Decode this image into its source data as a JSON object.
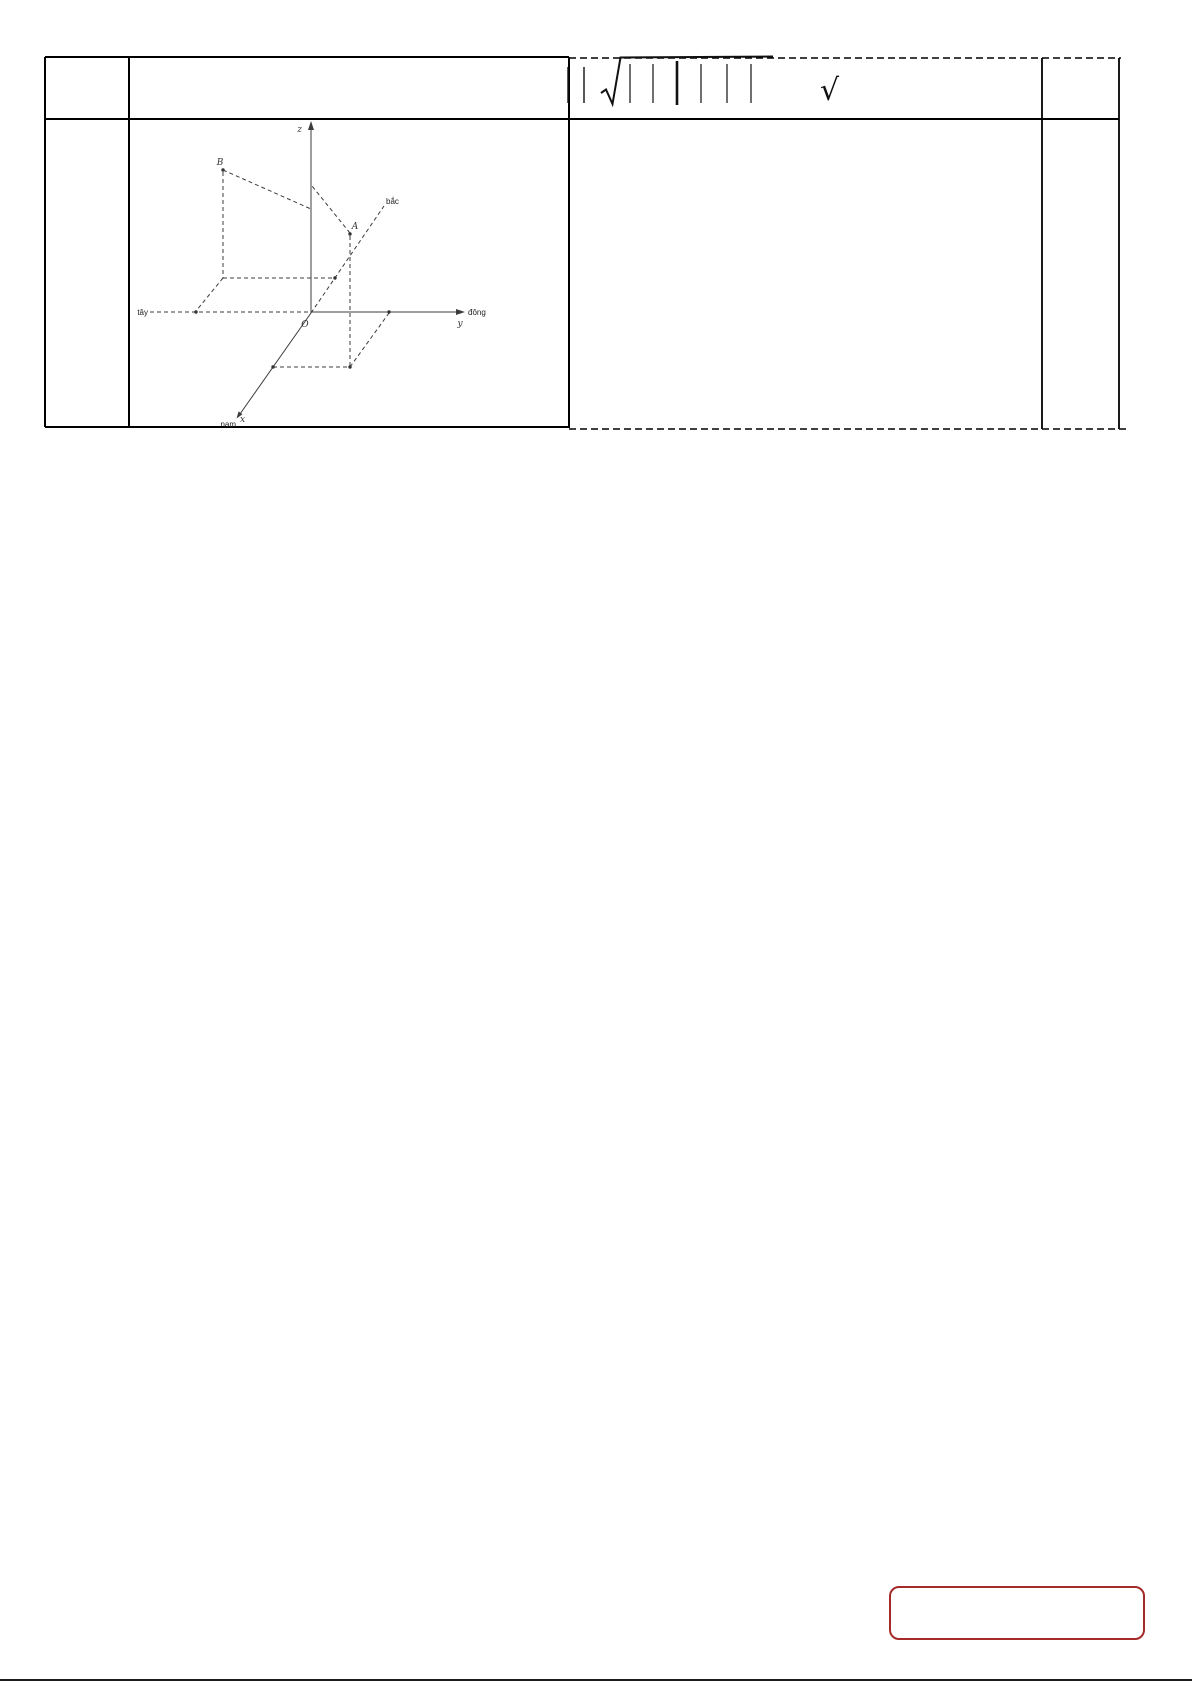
{
  "table": {
    "column_count": 4,
    "formula_cell": {
      "leading_abs_bars": 2,
      "radical_glyph": "√",
      "abs_bars_under_radical": 6
    }
  },
  "diagram": {
    "axis_labels": {
      "z": "z",
      "y": "y",
      "x": "x"
    },
    "origin_label": "O",
    "points": {
      "a": "A",
      "b": "B"
    },
    "compass": {
      "north": "bắc",
      "south": "nam",
      "east": "đông",
      "west": "tây"
    }
  },
  "annotation_box": {
    "border_color": "#a52a2a"
  },
  "colors": {
    "table_border": "#000000",
    "diagram_stroke": "#3c3c3c",
    "formula_ink": "#111111",
    "bottom_rule": "#1c1c1c"
  }
}
